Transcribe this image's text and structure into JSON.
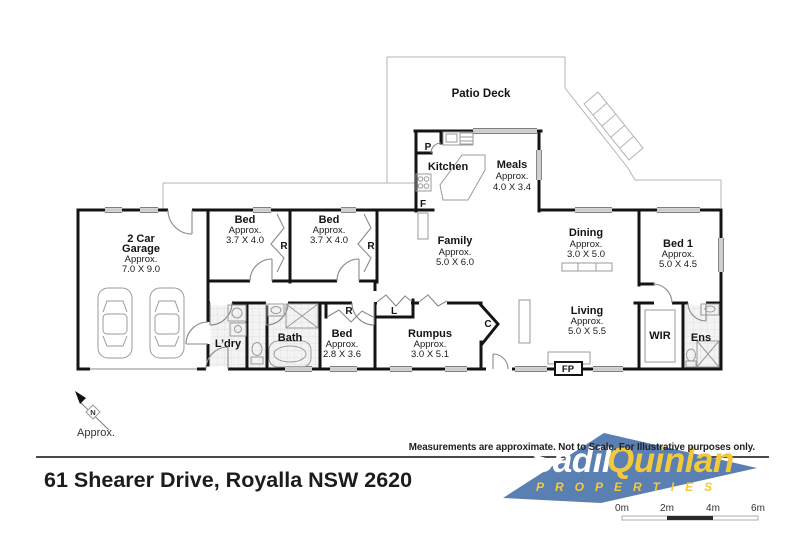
{
  "title_block": {
    "address": "61 Shearer Drive, Royalla NSW 2620",
    "disclaimer": "Measurements are approximate. Not to Scale. For Illustrative purposes only."
  },
  "logo": {
    "brand_first": "Sadil",
    "brand_second": "Quinlan",
    "brand_sub": "PROPERTIES",
    "brand_blue": "#5a7fb2",
    "brand_yellow": "#f3c93c"
  },
  "scale_bar": {
    "labels": [
      "0m",
      "2m",
      "4m",
      "6m"
    ]
  },
  "compass": {
    "north": "N",
    "caption": "Approx."
  },
  "rooms": {
    "patio_deck": {
      "name": "Patio Deck"
    },
    "garage": {
      "name_line1": "2 Car",
      "name_line2": "Garage",
      "approx": "Approx.",
      "dims": "7.0 X 9.0"
    },
    "bed_a": {
      "name": "Bed",
      "approx": "Approx.",
      "dims": "3.7 X 4.0"
    },
    "bed_b": {
      "name": "Bed",
      "approx": "Approx.",
      "dims": "3.7 X 4.0"
    },
    "family": {
      "name": "Family",
      "approx": "Approx.",
      "dims": "5.0 X 6.0"
    },
    "kitchen": {
      "name": "Kitchen"
    },
    "meals": {
      "name": "Meals",
      "approx": "Approx.",
      "dims": "4.0 X 3.4"
    },
    "dining": {
      "name": "Dining",
      "approx": "Approx.",
      "dims": "3.0 X 5.0"
    },
    "bed_1": {
      "name": "Bed 1",
      "approx": "Approx.",
      "dims": "5.0 X 4.5"
    },
    "living": {
      "name": "Living",
      "approx": "Approx.",
      "dims": "5.0 X 5.5"
    },
    "rumpus": {
      "name": "Rumpus",
      "approx": "Approx.",
      "dims": "3.0 X 5.1"
    },
    "bed_c": {
      "name": "Bed",
      "approx": "Approx.",
      "dims": "2.8 X 3.6"
    },
    "bath": {
      "name": "Bath"
    },
    "laundry": {
      "name": "L’dry"
    },
    "wir": {
      "name": "WIR"
    },
    "ens": {
      "name": "Ens"
    }
  },
  "markers": {
    "pantry": "P",
    "fridge": "F",
    "robe": "R",
    "linen": "L",
    "cupboard": "C",
    "fireplace": "FP"
  }
}
